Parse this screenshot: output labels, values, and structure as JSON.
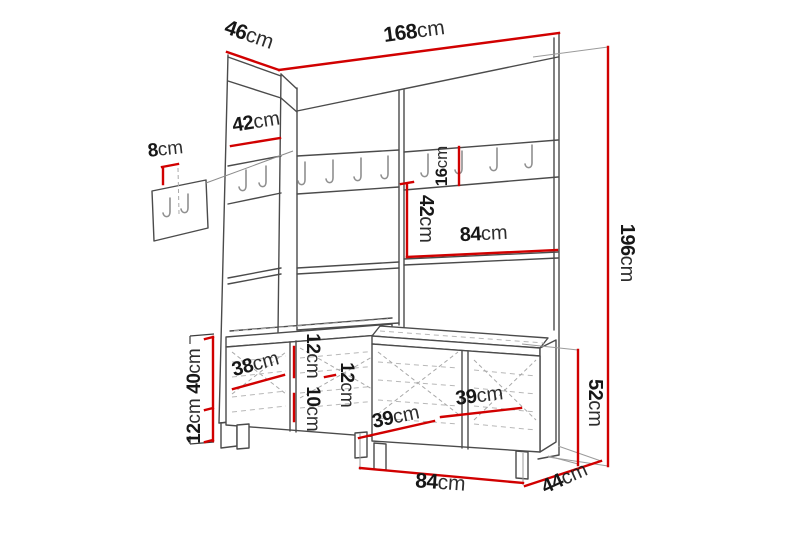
{
  "title": "Hallway furniture set dimension diagram",
  "colors": {
    "dimension": "#d10000",
    "outline": "#4b4b4b",
    "detail": "#8f8f8f",
    "label": "#171717",
    "background": "#ffffff"
  },
  "dimensions": {
    "total_width": {
      "value": "168",
      "unit": "cm"
    },
    "top_depth": {
      "value": "46",
      "unit": "cm"
    },
    "left_upper_section": {
      "value": "42",
      "unit": "cm"
    },
    "wall_hook_panel_depth": {
      "value": "8",
      "unit": "cm"
    },
    "hook_rail_height": {
      "value": "16",
      "unit": "cm"
    },
    "middle_section_height": {
      "value": "42",
      "unit": "cm"
    },
    "panel_half_width": {
      "value": "84",
      "unit": "cm"
    },
    "bench_diagonal_depth": {
      "value": "38",
      "unit": "cm"
    },
    "drawer_front_upper": {
      "value": "12",
      "unit": "cm"
    },
    "drawer_front_lower": {
      "value": "10",
      "unit": "cm"
    },
    "drawer_front_right": {
      "value": "12",
      "unit": "cm"
    },
    "bench_body_height": {
      "value": "40",
      "unit": "cm"
    },
    "leg_height": {
      "value": "12",
      "unit": "cm"
    },
    "drawer_width_left": {
      "value": "39",
      "unit": "cm"
    },
    "drawer_width_right": {
      "value": "39",
      "unit": "cm"
    },
    "bench_total_height": {
      "value": "52",
      "unit": "cm"
    },
    "bench_width": {
      "value": "84",
      "unit": "cm"
    },
    "bench_depth": {
      "value": "44",
      "unit": "cm"
    },
    "total_height": {
      "value": "196",
      "unit": "cm"
    }
  }
}
